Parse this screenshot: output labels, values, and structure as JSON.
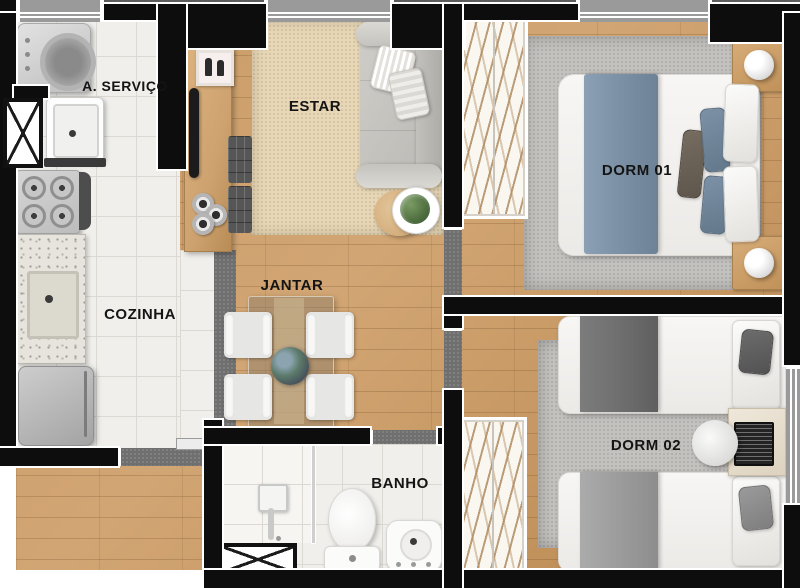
{
  "palette": {
    "wall": "#0d0d0d",
    "exterior-gray": "#5c5c5c",
    "window-gray": "#9a9a9a",
    "opening-gray": "#6f6f6f",
    "wood": "#c89a66",
    "wood-dark": "#b9874f",
    "tile": "#f0efeb",
    "tile-line": "#dcd9d3",
    "rug-beige": "#e7d7b6",
    "rug-gray": "#c4c2bf",
    "counter-wood": "#cda26f",
    "blanket-blue": "#7e93a7",
    "blanket-dark": "#6f6f6f",
    "blanket-light": "#9c9c9c",
    "label": "#141414"
  },
  "rooms": {
    "servico": {
      "label": "A. SERVIÇO"
    },
    "cozinha": {
      "label": "COZINHA"
    },
    "estar": {
      "label": "ESTAR"
    },
    "jantar": {
      "label": "JANTAR"
    },
    "banho": {
      "label": "BANHO"
    },
    "dorm1": {
      "label": "DORM 01"
    },
    "dorm2": {
      "label": "DORM 02"
    }
  }
}
